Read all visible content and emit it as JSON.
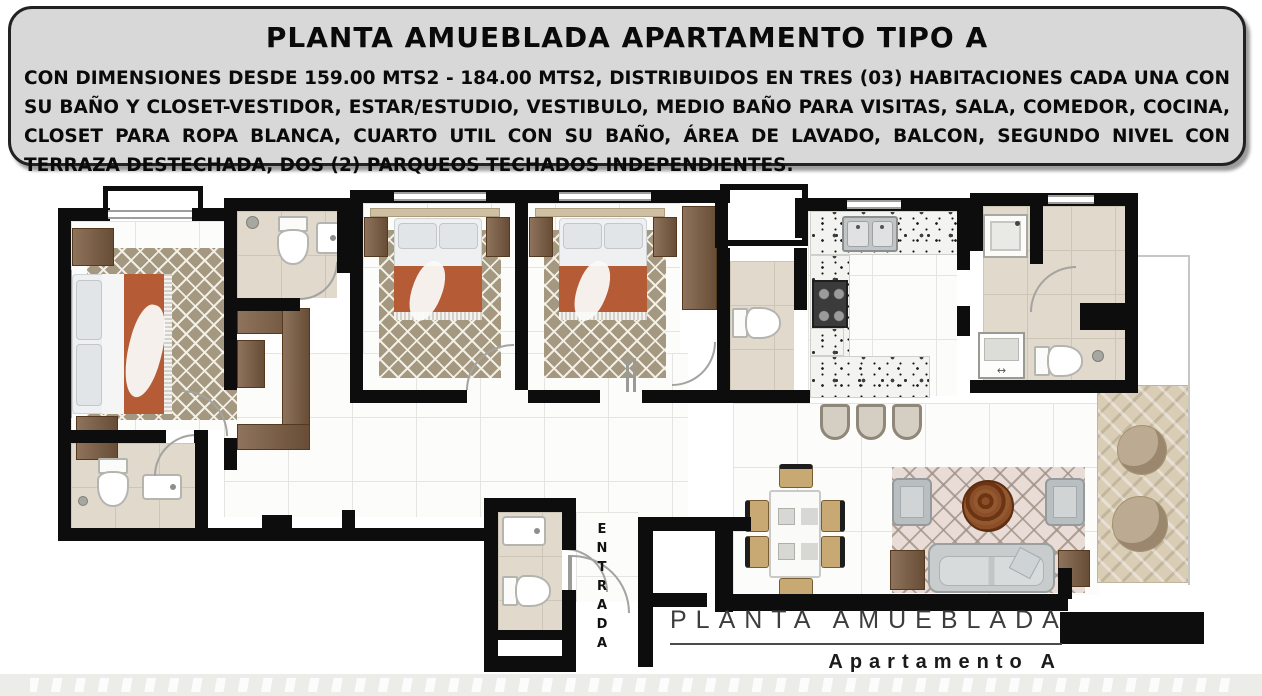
{
  "header": {
    "title": "PLANTA AMUEBLADA APARTAMENTO TIPO A",
    "description": "CON DIMENSIONES DESDE 159.00 MTS2 - 184.00 MTS2, DISTRIBUIDOS EN TRES (03) HABITACIONES CADA UNA CON SU BAÑO Y CLOSET-VESTIDOR, ESTAR/ESTUDIO, VESTIBULO, MEDIO BAÑO PARA VISITAS, SALA, COMEDOR, COCINA, CLOSET PARA ROPA BLANCA, CUARTO UTIL CON SU BAÑO, ÁREA DE LAVADO, BALCON, SEGUNDO NIVEL CON TERRAZA DESTECHADA, DOS (2) PARQUEOS TECHADOS INDEPENDIENTES."
  },
  "plan": {
    "entrance_label": "ENTRADA",
    "caption_title": "PLANTA AMUEBLADA",
    "caption_subtitle": "Apartamento A"
  },
  "colors": {
    "wall": "#0d0d0d",
    "header_panel": "#d8d8d8",
    "rug_taupe": "#a59880",
    "blanket_rust": "#b55c36",
    "wood_brown": "#7c5c41",
    "terrace_wood": "#d9cdb6",
    "sofa_gray": "#c9cccd",
    "bath_beige": "#e0d9cc",
    "floor_white": "#fcfcfb"
  }
}
